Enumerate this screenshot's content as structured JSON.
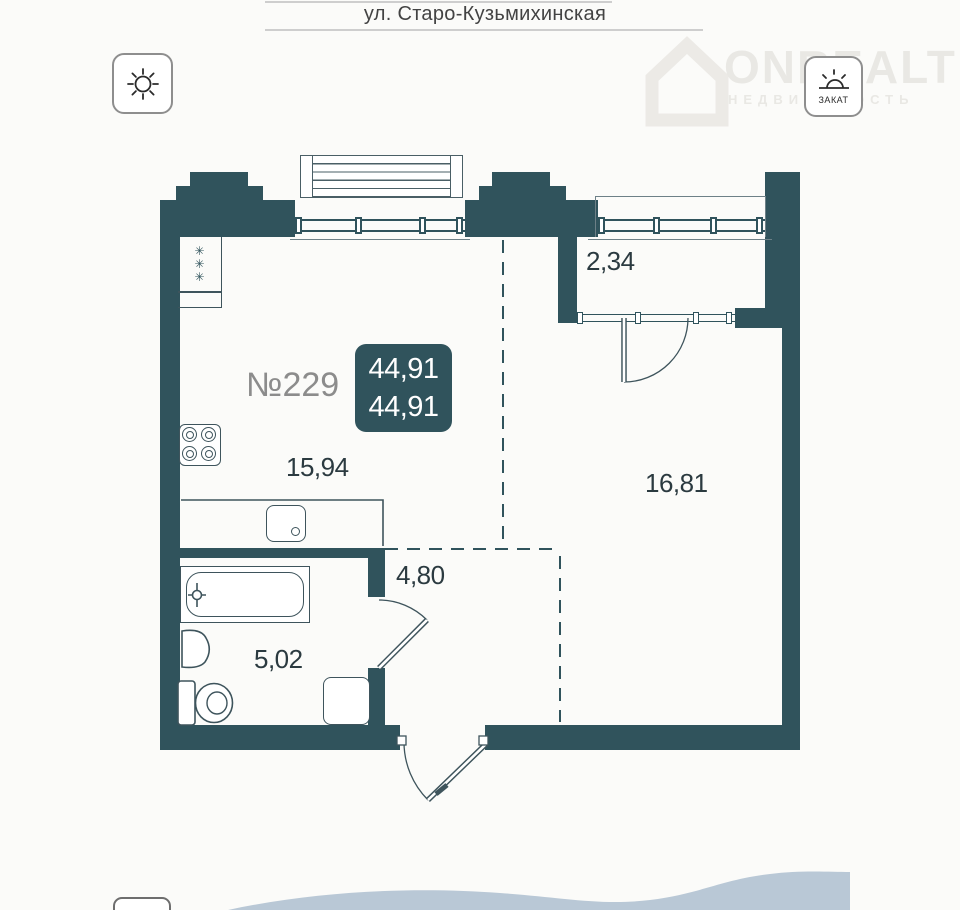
{
  "header": {
    "street": "ул. Старо-Кузьмихинская"
  },
  "watermark": {
    "brand": "ONREALT",
    "subtitle": "НЕДВИЖИМОСТЬ"
  },
  "orientation": {
    "sunset_label": "ЗАКАТ"
  },
  "apartment": {
    "number": "№229",
    "area_top": "44,91",
    "area_bottom": "44,91"
  },
  "areas": {
    "balcony": "2,34",
    "kitchen_living": "15,94",
    "room": "16,81",
    "hallway": "4,80",
    "bathroom": "5,02"
  },
  "plan": {
    "vent_symbol": "✳"
  },
  "colors": {
    "wall": "#30535c",
    "line": "#3e545c",
    "label": "#2b3a40",
    "number_gray": "#8c8c8c",
    "badge_text": "#ffffff",
    "wave": "#b9c8d6",
    "watermark": "#e9e8e4"
  }
}
